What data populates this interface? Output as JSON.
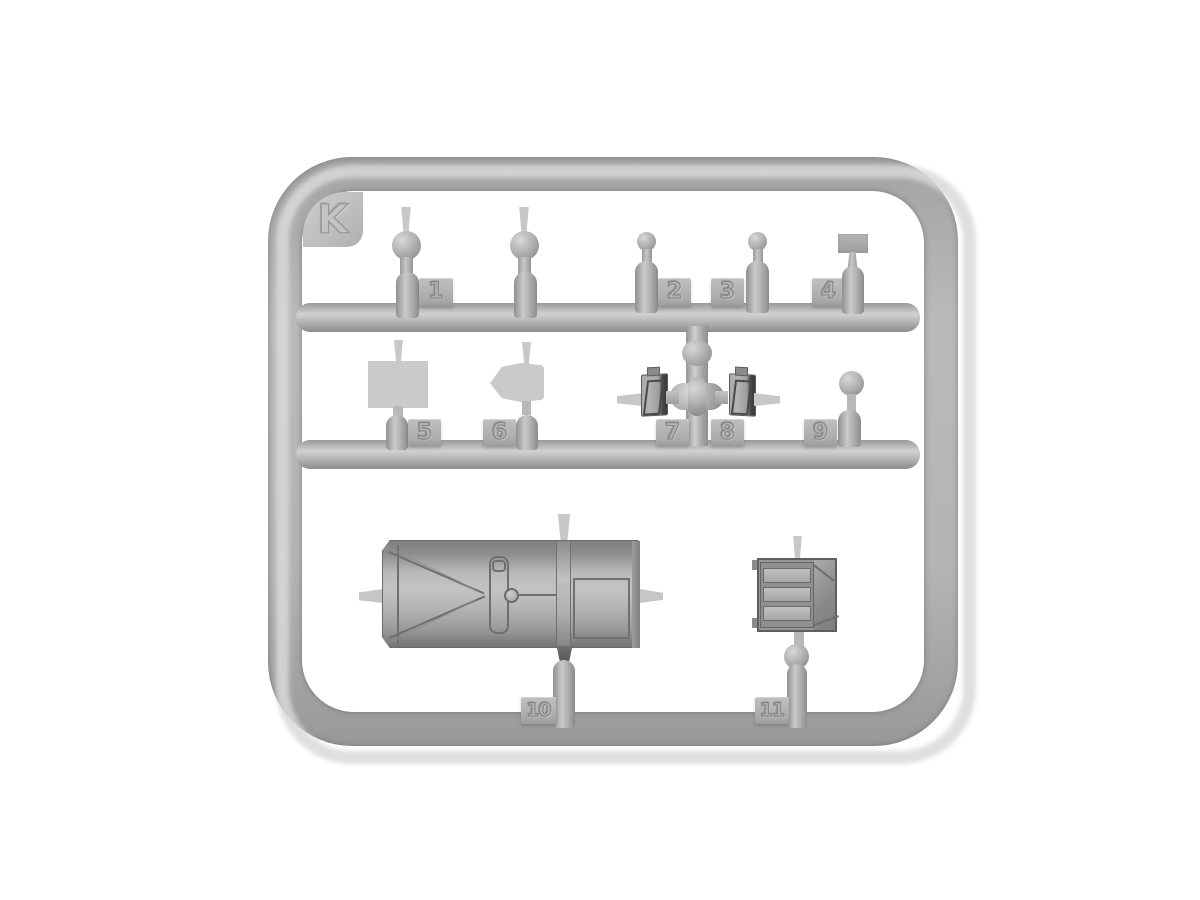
{
  "sprue": {
    "frame_label": "K",
    "plastic_color": "#b3b4b4",
    "background_color": "#ffffff",
    "parts": [
      {
        "number": "1",
        "name": "lever-large-ball-knob",
        "copies": 2
      },
      {
        "number": "2",
        "name": "lever-small-ball-knob",
        "copies": 1
      },
      {
        "number": "3",
        "name": "lever-small-ball-knob",
        "copies": 1
      },
      {
        "number": "4",
        "name": "lever-rectangular-pad",
        "copies": 1
      },
      {
        "number": "5",
        "name": "flat-square-plate",
        "copies": 1
      },
      {
        "number": "6",
        "name": "flat-hexagonal-plate",
        "copies": 1
      },
      {
        "number": "7",
        "name": "pedal-left",
        "copies": 1
      },
      {
        "number": "8",
        "name": "pedal-right",
        "copies": 1
      },
      {
        "number": "9",
        "name": "flat-round-disc",
        "copies": 1
      },
      {
        "number": "10",
        "name": "large-hood-housing",
        "copies": 1
      },
      {
        "number": "11",
        "name": "stowage-box",
        "copies": 1
      }
    ]
  }
}
